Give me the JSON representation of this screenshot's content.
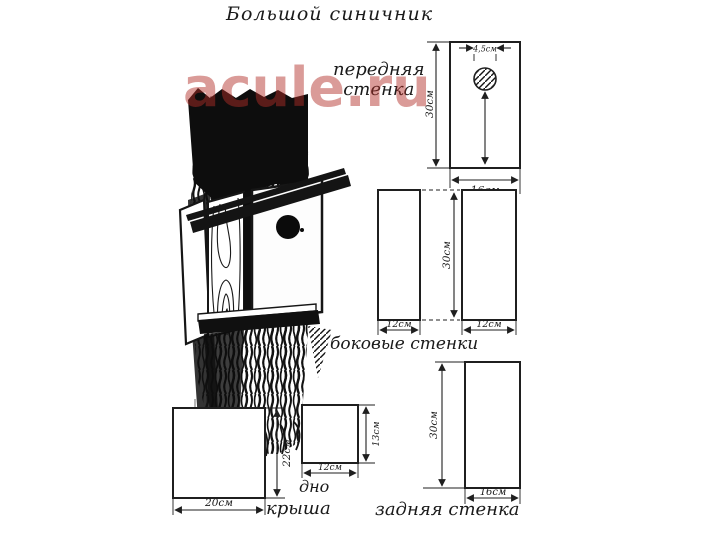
{
  "title": "Большой синичник",
  "watermark": "acule.ru",
  "colors": {
    "ink": "#1f1f1f",
    "watermark_red": "#b22d28",
    "paper": "#ffffff"
  },
  "parts": {
    "front_wall": {
      "label_line1": "передняя",
      "label_line2": "стенка",
      "height": "30см",
      "width": "16см",
      "hole_diameter": "4,5см"
    },
    "side_walls": {
      "label": "боковые стенки",
      "height": "30см",
      "left_width": "12см",
      "right_width": "12см"
    },
    "roof": {
      "label": "крыша",
      "height": "22см",
      "width": "20см"
    },
    "bottom": {
      "label": "дно",
      "height": "13см",
      "width": "12см"
    },
    "back_wall": {
      "label": "задняя стенка",
      "height": "30см",
      "width": "16см"
    }
  }
}
